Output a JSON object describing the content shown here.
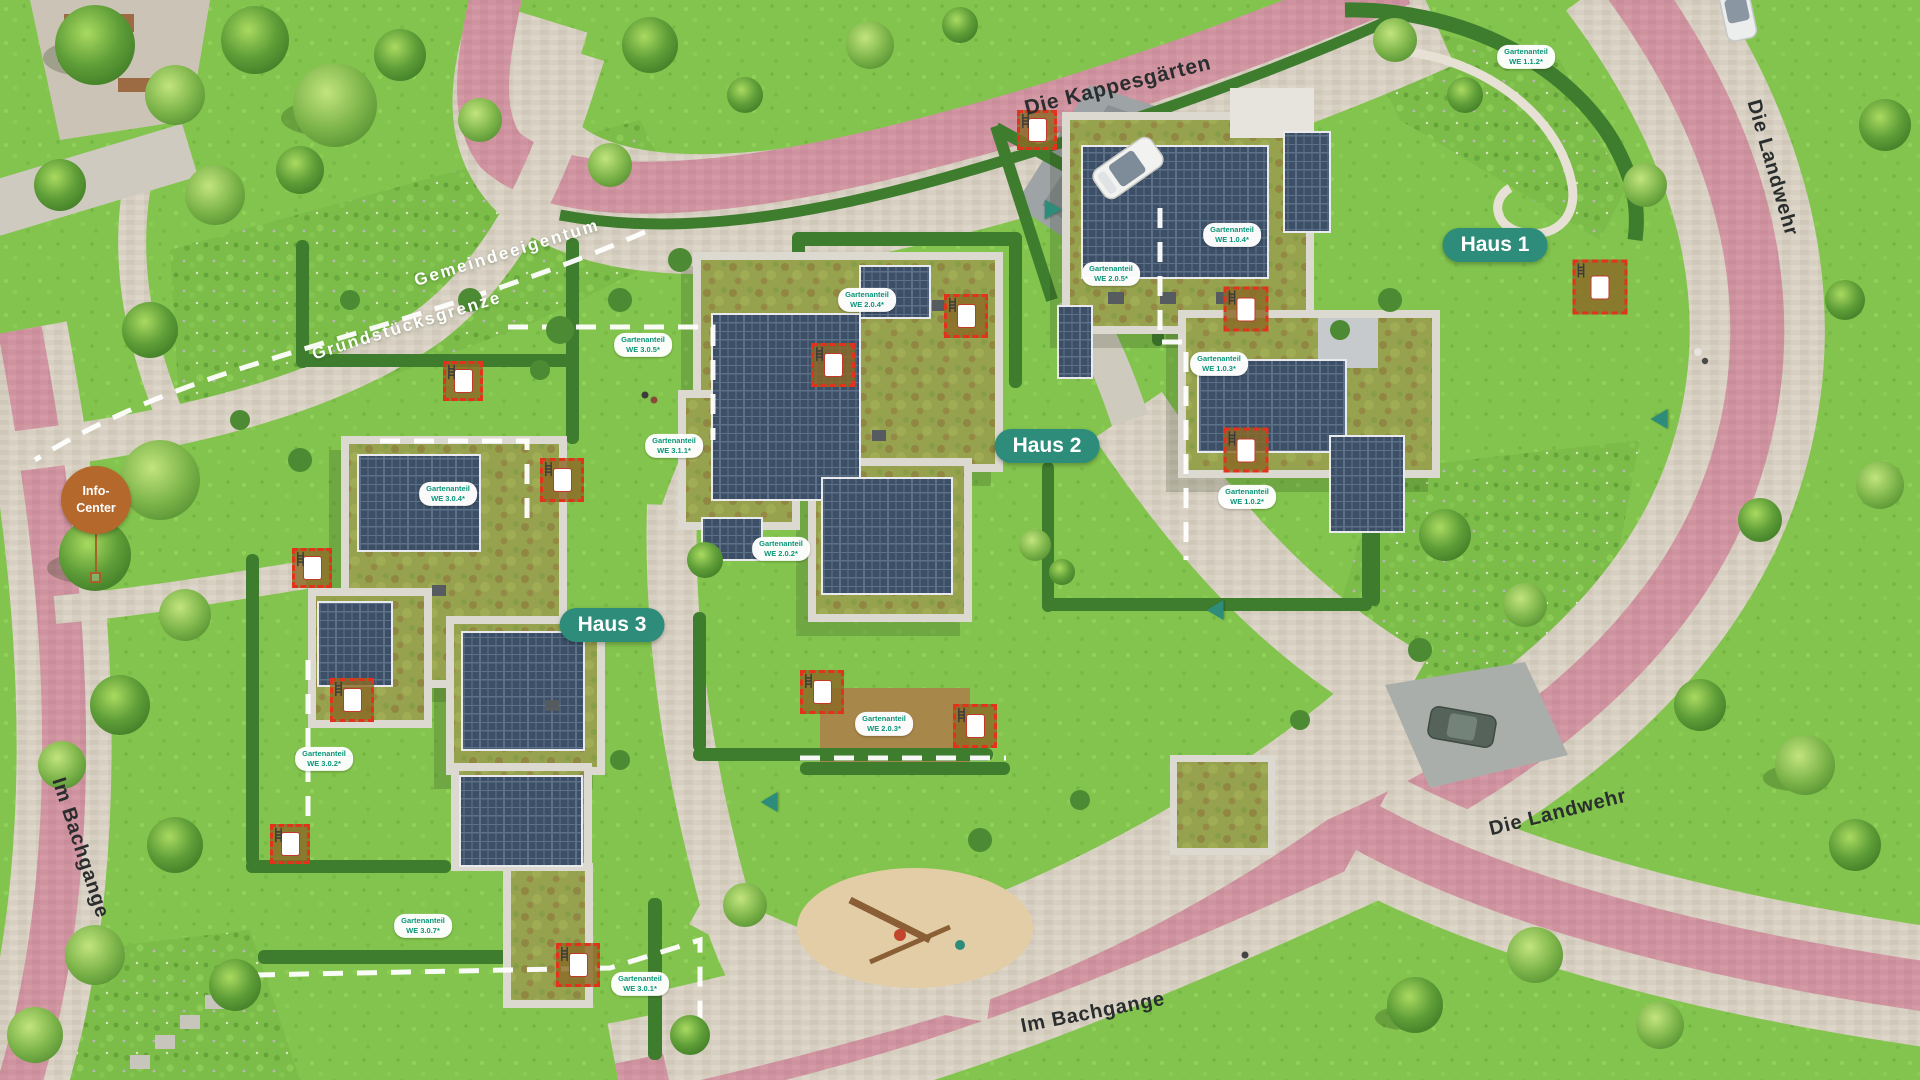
{
  "colors": {
    "accent_teal": "#2e8c7a",
    "garden_pill_text": "#0b957a",
    "info_orange": "#b5682c",
    "road_pink": "#cf93a0",
    "marker_red": "#e2321c",
    "grass_green": "#82c44d",
    "hedge_green": "#3f7d2e"
  },
  "streets": [
    {
      "name": "Die Kappesgärten",
      "x": 1118,
      "y": 86,
      "rotation": -14,
      "size": 21
    },
    {
      "name": "Die Landwehr",
      "x": 1772,
      "y": 168,
      "rotation": 74,
      "size": 20
    },
    {
      "name": "Die Landwehr",
      "x": 1558,
      "y": 813,
      "rotation": -14,
      "size": 20
    },
    {
      "name": "Im Bachgange",
      "x": 80,
      "y": 848,
      "rotation": 72,
      "size": 20
    },
    {
      "name": "Im Bachgange",
      "x": 1093,
      "y": 1013,
      "rotation": -11,
      "size": 20
    }
  ],
  "boundary_labels": [
    {
      "name": "Gemeindeeigentum",
      "x": 507,
      "y": 253,
      "rotation": -17
    },
    {
      "name": "Grundstücksgrenze",
      "x": 407,
      "y": 326,
      "rotation": -17
    }
  ],
  "houses": [
    {
      "name": "Haus 1",
      "x": 1495,
      "y": 245
    },
    {
      "name": "Haus 2",
      "x": 1047,
      "y": 446
    },
    {
      "name": "Haus 3",
      "x": 612,
      "y": 625
    }
  ],
  "info_center": {
    "line1": "Info-",
    "line2": "Center",
    "x": 96,
    "y": 500
  },
  "garden_labels": [
    {
      "line1": "Gartenanteil",
      "line2": "WE 1.1.2*",
      "x": 1526,
      "y": 57
    },
    {
      "line1": "Gartenanteil",
      "line2": "WE 1.0.4*",
      "x": 1232,
      "y": 235
    },
    {
      "line1": "Gartenanteil",
      "line2": "WE 2.0.5*",
      "x": 1111,
      "y": 274
    },
    {
      "line1": "Gartenanteil",
      "line2": "WE 1.0.3*",
      "x": 1219,
      "y": 364
    },
    {
      "line1": "Gartenanteil",
      "line2": "WE 1.0.2*",
      "x": 1247,
      "y": 497
    },
    {
      "line1": "Gartenanteil",
      "line2": "WE 2.0.4*",
      "x": 867,
      "y": 300
    },
    {
      "line1": "Gartenanteil",
      "line2": "WE 3.0.5*",
      "x": 643,
      "y": 345
    },
    {
      "line1": "Gartenanteil",
      "line2": "WE 3.1.1*",
      "x": 674,
      "y": 446
    },
    {
      "line1": "Gartenanteil",
      "line2": "WE 3.0.4*",
      "x": 448,
      "y": 494
    },
    {
      "line1": "Gartenanteil",
      "line2": "WE 2.0.2*",
      "x": 781,
      "y": 549
    },
    {
      "line1": "Gartenanteil",
      "line2": "WE 2.0.3*",
      "x": 884,
      "y": 724
    },
    {
      "line1": "Gartenanteil",
      "line2": "WE 3.0.2*",
      "x": 324,
      "y": 759
    },
    {
      "line1": "Gartenanteil",
      "line2": "WE 3.0.7*",
      "x": 423,
      "y": 926
    },
    {
      "line1": "Gartenanteil",
      "line2": "WE 3.0.1*",
      "x": 640,
      "y": 984
    }
  ],
  "terrace_markers": [
    {
      "x": 1037,
      "y": 130,
      "size": 40
    },
    {
      "x": 1600,
      "y": 287,
      "size": 55
    },
    {
      "x": 1246,
      "y": 309,
      "size": 45
    },
    {
      "x": 1246,
      "y": 450,
      "size": 45
    },
    {
      "x": 966,
      "y": 316,
      "size": 44
    },
    {
      "x": 833,
      "y": 365,
      "size": 44
    },
    {
      "x": 562,
      "y": 480,
      "size": 44
    },
    {
      "x": 463,
      "y": 381,
      "size": 40
    },
    {
      "x": 312,
      "y": 568,
      "size": 40
    },
    {
      "x": 352,
      "y": 700,
      "size": 44
    },
    {
      "x": 290,
      "y": 844,
      "size": 40
    },
    {
      "x": 822,
      "y": 692,
      "size": 44
    },
    {
      "x": 975,
      "y": 726,
      "size": 44
    },
    {
      "x": 578,
      "y": 965,
      "size": 44
    }
  ],
  "entrance_arrows": [
    {
      "x": 1049,
      "y": 207,
      "rotation": -30
    },
    {
      "x": 1215,
      "y": 610,
      "rotation": -90
    },
    {
      "x": 769,
      "y": 802,
      "rotation": -90
    },
    {
      "x": 1659,
      "y": 419,
      "rotation": -90
    }
  ]
}
